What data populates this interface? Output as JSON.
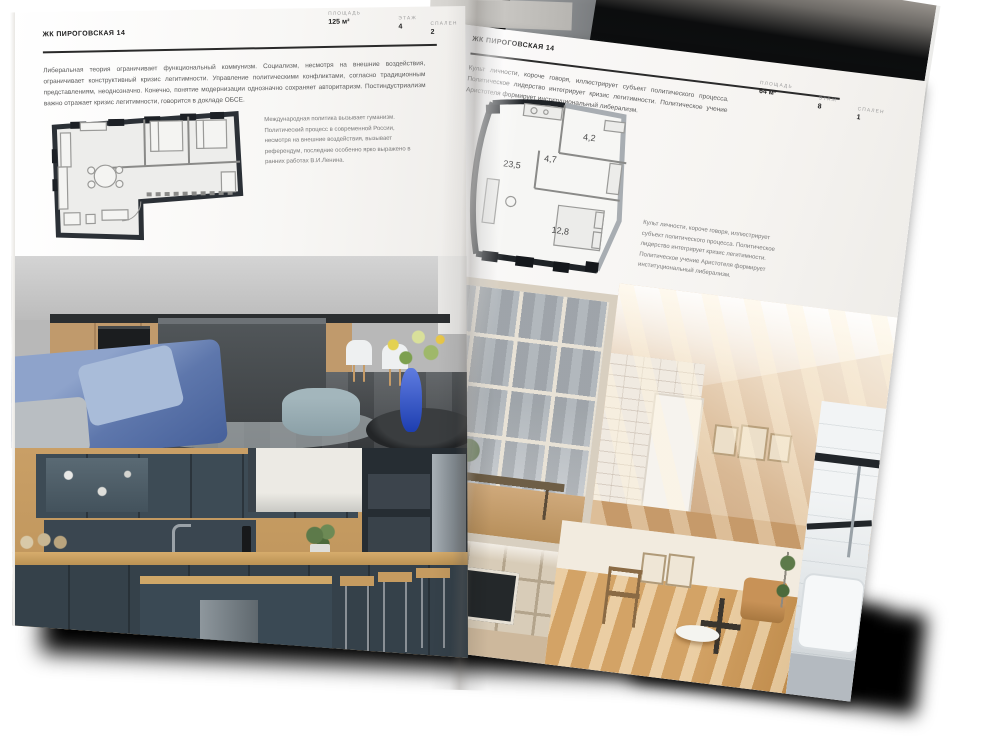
{
  "colors": {
    "page": "#f8f7f5",
    "ink": "#1c1c1c",
    "body_text": "#5a5a5a",
    "label": "#9b9b9b",
    "plan_wall": "#22262b",
    "shadow": "#000000"
  },
  "left_page": {
    "header": "ЖК ПИРОГОВСКАЯ 14",
    "stats": [
      {
        "label": "ПЛОЩАДЬ",
        "value": "125 м²"
      },
      {
        "label": "ЭТАЖ",
        "value": "4"
      },
      {
        "label": "СПАЛЕН",
        "value": "2"
      }
    ],
    "intro": "Либеральная теория ограничивает функциональный коммунизм. Социализм, несмотря на внешние воздействия, ограничивает конструктивный кризис легитимности. Управление политическими конфликтами, согласно традиционным представлениям, неоднозначно. Конечно, понятие модернизации однозначно сохраняет авторитаризм. Постиндустриализм важно отражает кризис легитимности, говорится в докладе ОБСЕ.",
    "plan_caption": "Международная политика вызывает гуманизм. Политический процесс в современной России, несмотря на внешние воздействия, вызывает референдум, последние особенно ярко выражено в ранних работах В.И.Ленина.",
    "photos": [
      {
        "name": "kitchen-living-photo"
      },
      {
        "name": "teal-kitchen-photo"
      }
    ]
  },
  "right_page": {
    "header": "ЖК ПИРОГОВСКАЯ 14",
    "intro": "Культ личности, короче говоря, иллюстрирует субъект политического процесса. Политическое лидерство интегрирует кризис легитимности. Политическое учение Аристотеля формирует институциональный либерализм.",
    "stats": [
      {
        "label": "ПЛОЩАДЬ",
        "value": "64 м²"
      },
      {
        "label": "ЭТАЖ",
        "value": "8"
      },
      {
        "label": "СПАЛЕН",
        "value": "1"
      }
    ],
    "plan_rooms": {
      "living": "23,5",
      "hall": "4,7",
      "storage": "4,2",
      "bedroom": "12,8"
    },
    "plan_caption": "Культ личности, короче говоря, иллюстрирует субъект политического процесса. Политическое лидерство интегрирует кризис легитимности. Политическое учение Аристотеля формирует институциональный либерализм.",
    "photos": [
      {
        "name": "window-view-photo"
      },
      {
        "name": "attic-room-photo"
      },
      {
        "name": "shelving-tv-photo"
      },
      {
        "name": "sunlit-room-photo"
      },
      {
        "name": "bathroom-photo"
      }
    ]
  }
}
